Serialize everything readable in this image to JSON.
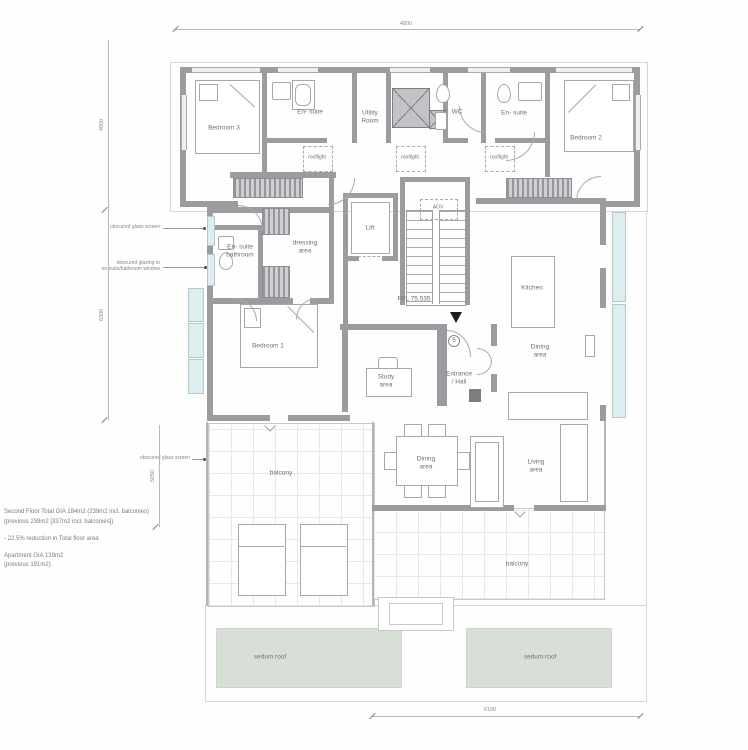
{
  "labels": {
    "bedroom3": "Bedroom 3",
    "ensuite_top_left": "En- suite",
    "utility_room": "Utility\nRoom",
    "wc": "WC",
    "ensuite_top_right": "En- suite",
    "bedroom2": "Bedroom 2",
    "rooflight": "rooflight",
    "dressing_area": "dressing\narea",
    "lift": "Lift",
    "aov": "AOV",
    "ensuite_bathroom": "En- suite\nbathroom",
    "bedroom1": "Bedroom 1",
    "ffl_level": "FFL 75.535",
    "kitchen": "Kitchen",
    "dining_area_kitchen": "Dining\narea",
    "study_area": "Study\narea",
    "entrance_hall": "Entrance\n/ Hall",
    "stair_ref": "5",
    "balcony_left": "balcony",
    "dining_area_table": "Dining\narea",
    "living_area": "Living\narea",
    "balcony_right": "balcony",
    "sedum_roof_left": "sedum roof",
    "sedum_roof_right": "sedum roof"
  },
  "annotations": {
    "obscured_glass_screen_upper": "obscured glass screen",
    "obscured_glazing_note": "obscured glazing to\nen-suite/bathroom window",
    "obscured_glass_screen_lower": "obscured glass screen"
  },
  "dimensions": {
    "top": "4800",
    "left_upper": "4900",
    "left_lower": "6300",
    "left_balcony": "5050",
    "bottom": "6100"
  },
  "notes": {
    "line1": "Second Floor  Total GIA 184m2 (239m2 incl. balconies)",
    "line2": "(previous 238m2 [337m2 incl. balconies])",
    "line3": "- 22.5% reduction in Total floor area",
    "line4": "Apartment  GIA  139m2",
    "line5": "(previous 191m2)"
  },
  "colors": {
    "wall": "#9c9ca0",
    "glazing": "#ddeef1",
    "sedum_roof": "#d8dfd6",
    "line": "#a6a6aa",
    "text": "#6f6f74"
  }
}
